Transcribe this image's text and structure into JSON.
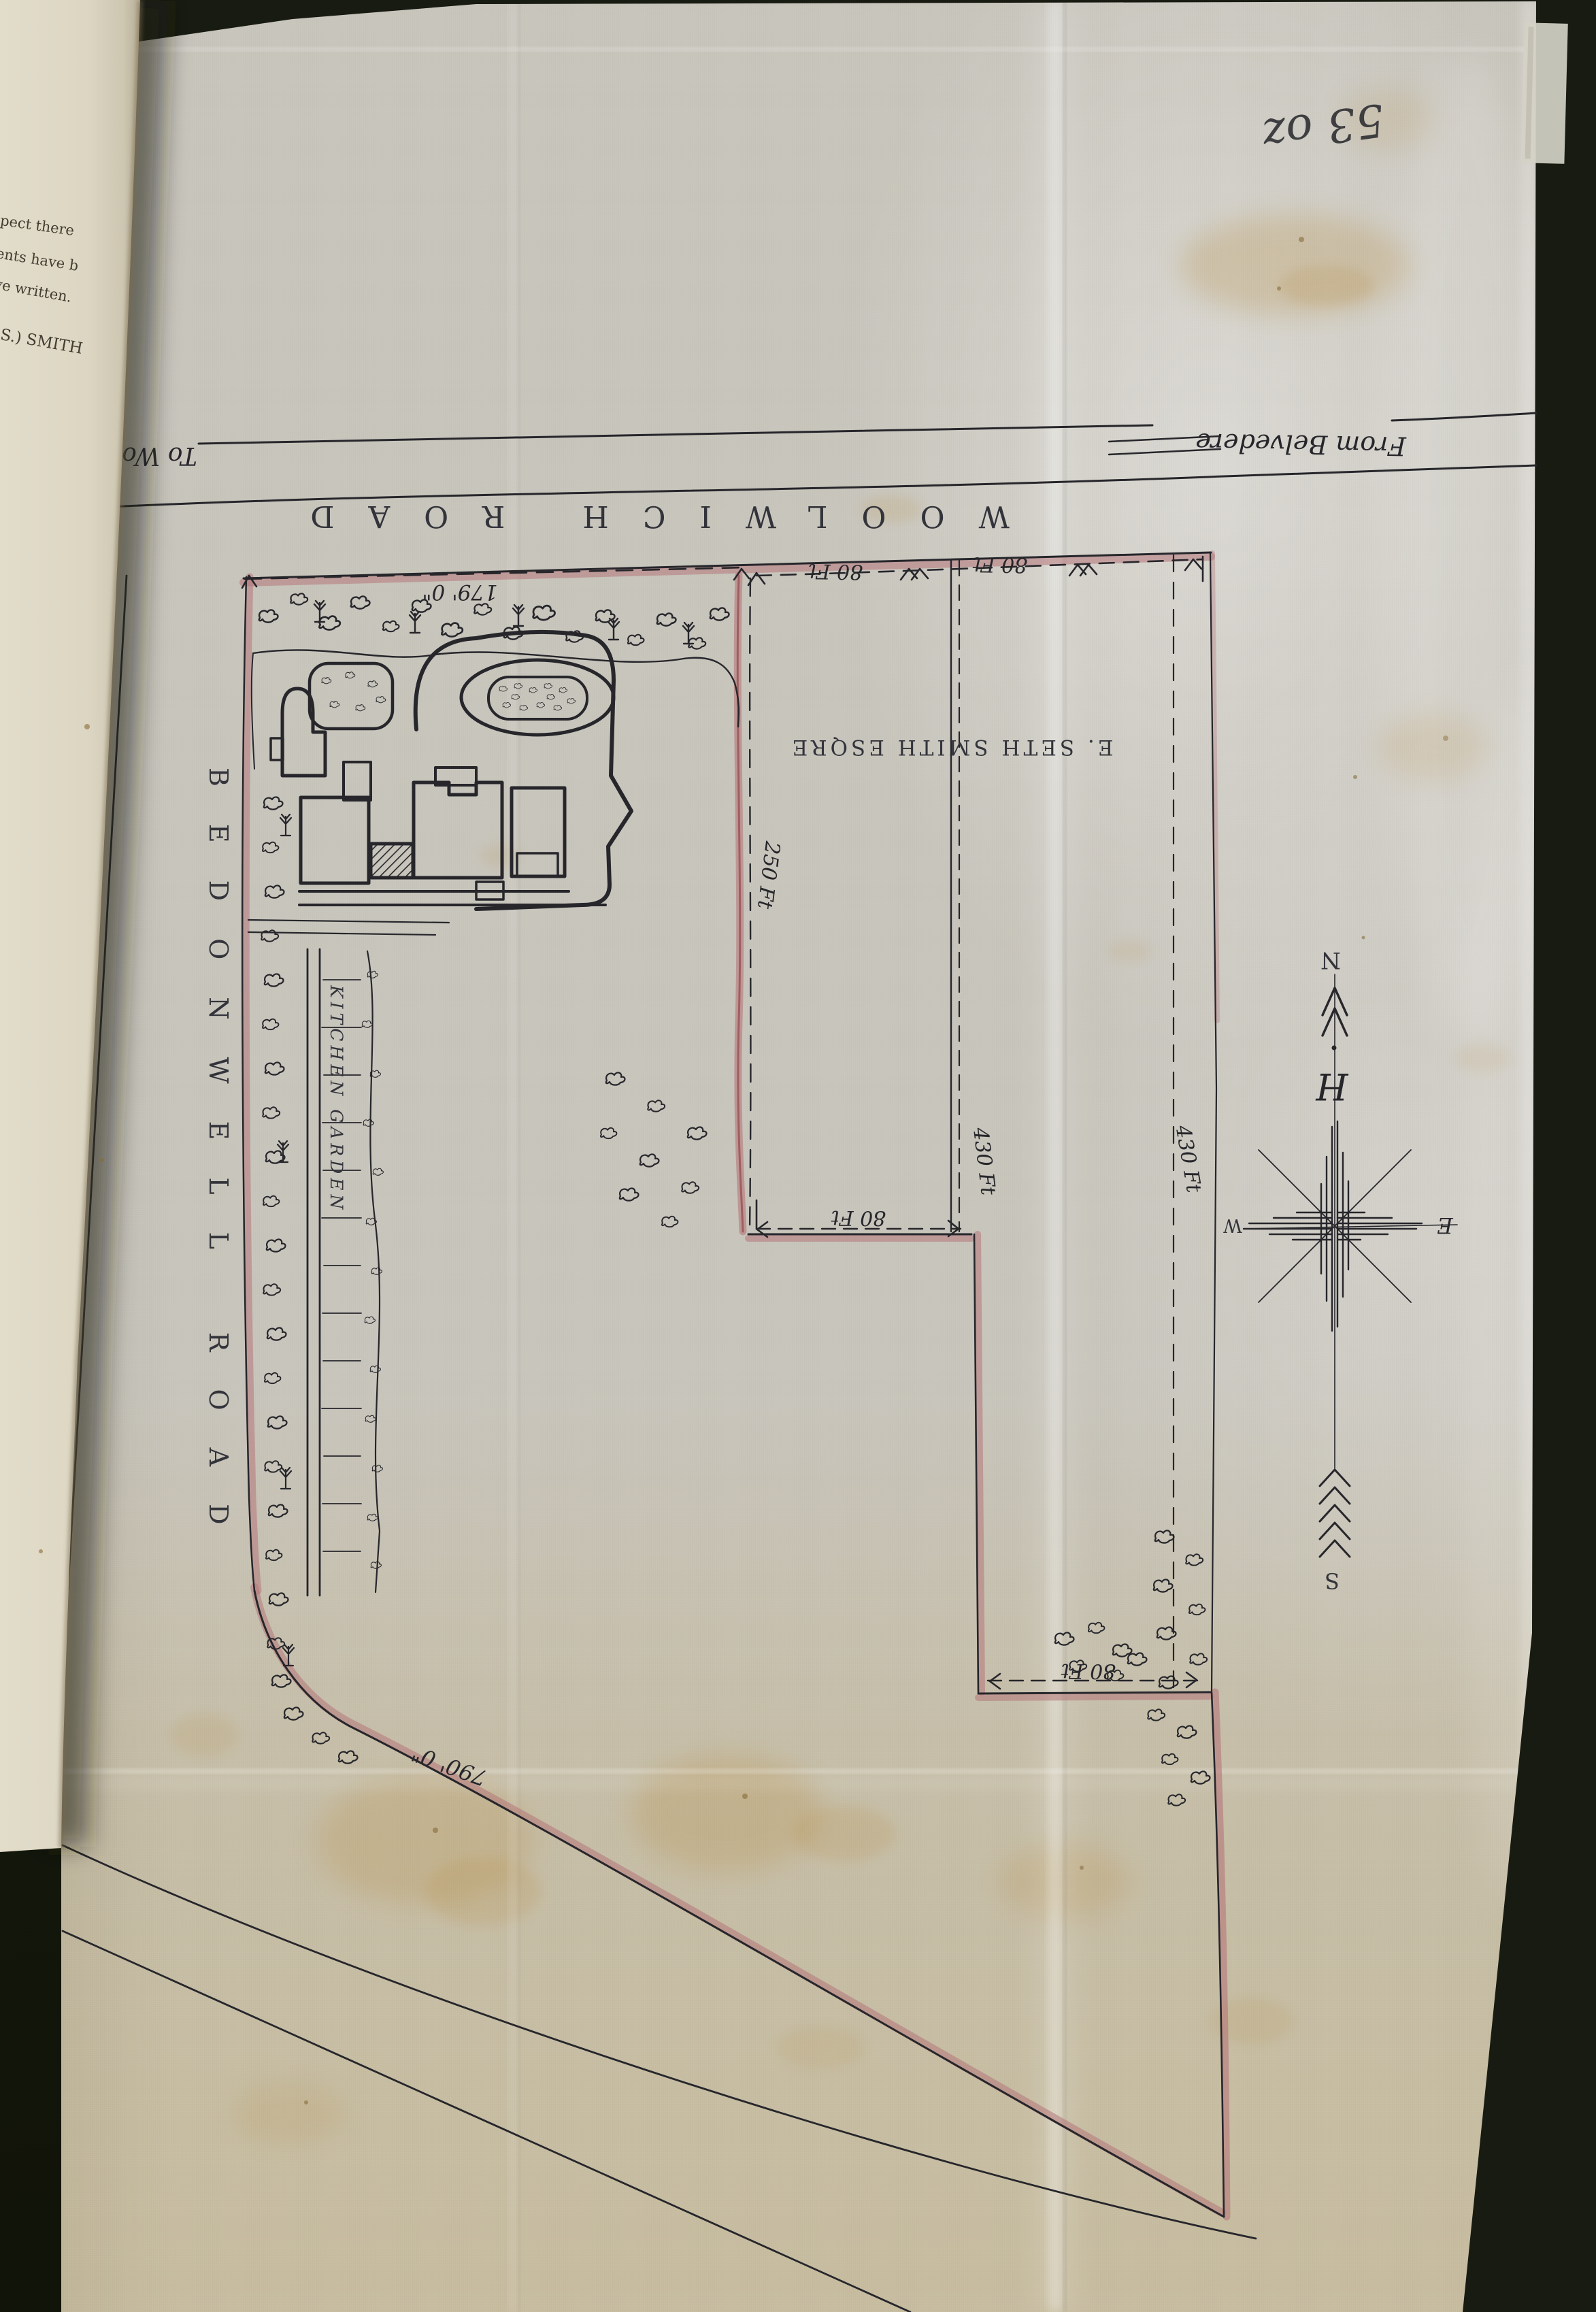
{
  "inscription": {
    "folio_mark": "53 oz"
  },
  "book_page": {
    "lines": [
      "respect there",
      "resents have b",
      "bove written.",
      "I  (L.S.)  SMITH"
    ]
  },
  "roads": {
    "woolwich_name": "WOOLWICH   ROAD",
    "to_note": "To Woolwich",
    "from_note": "From Belvedere",
    "bedonwell_name": "BEDONWELL   ROAD"
  },
  "labels": {
    "owner": "E. SETH SMITH ESQRE",
    "kitchen_garden": "KITCHEN  GARDEN"
  },
  "dimensions": {
    "frontage_house": "179' 0\"",
    "frontage_a": "80 Ft",
    "frontage_b": "80 Ft",
    "depth_house": "250 Ft",
    "depth_a": "430 Ft",
    "depth_b": "430 Ft",
    "width_mid": "80 Ft",
    "width_low": "80 Ft",
    "road_side": "790' 0\""
  },
  "compass": {
    "north": "N",
    "south": "S",
    "east": "E",
    "west": "W",
    "ornament": "H"
  },
  "colors": {
    "ink": "#26262b",
    "boundary_pink": "#b5767a",
    "sheet": "#c8c5bc",
    "page": "#ddd7c5",
    "backdrop": "#181b11"
  }
}
